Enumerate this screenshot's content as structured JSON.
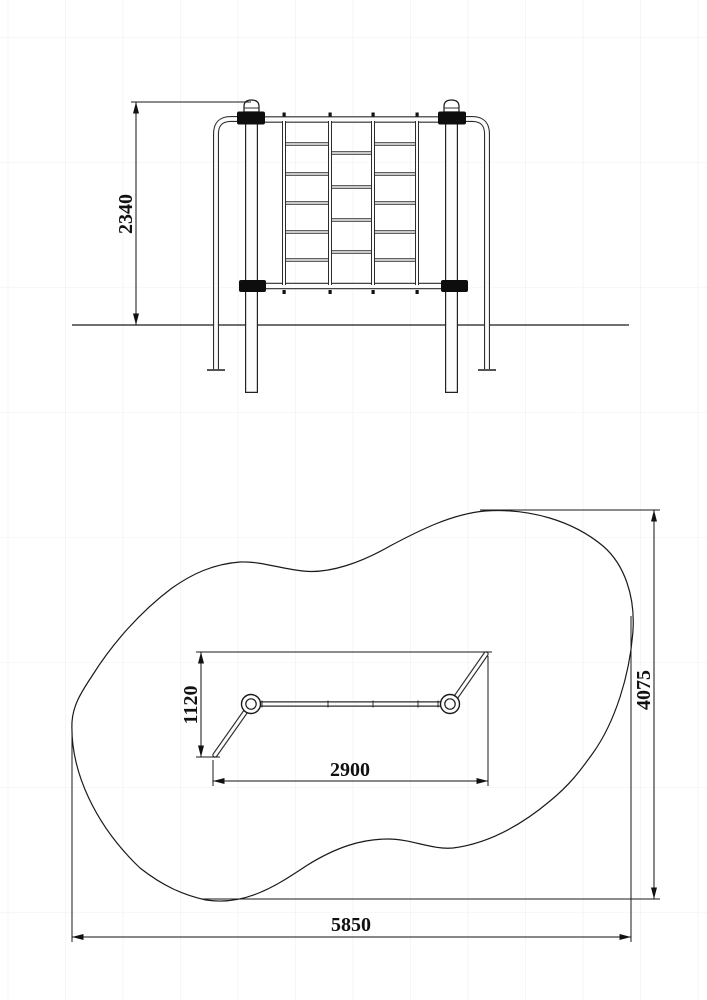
{
  "drawing": {
    "line_color": "#1a1a1a",
    "background_color": "#ffffff",
    "views": {
      "elevation": {
        "dim_height": "2340"
      },
      "plan": {
        "dim_equipment_depth": "1120",
        "dim_equipment_width": "2900",
        "dim_zone_depth": "4075",
        "dim_zone_width": "5850"
      }
    }
  }
}
